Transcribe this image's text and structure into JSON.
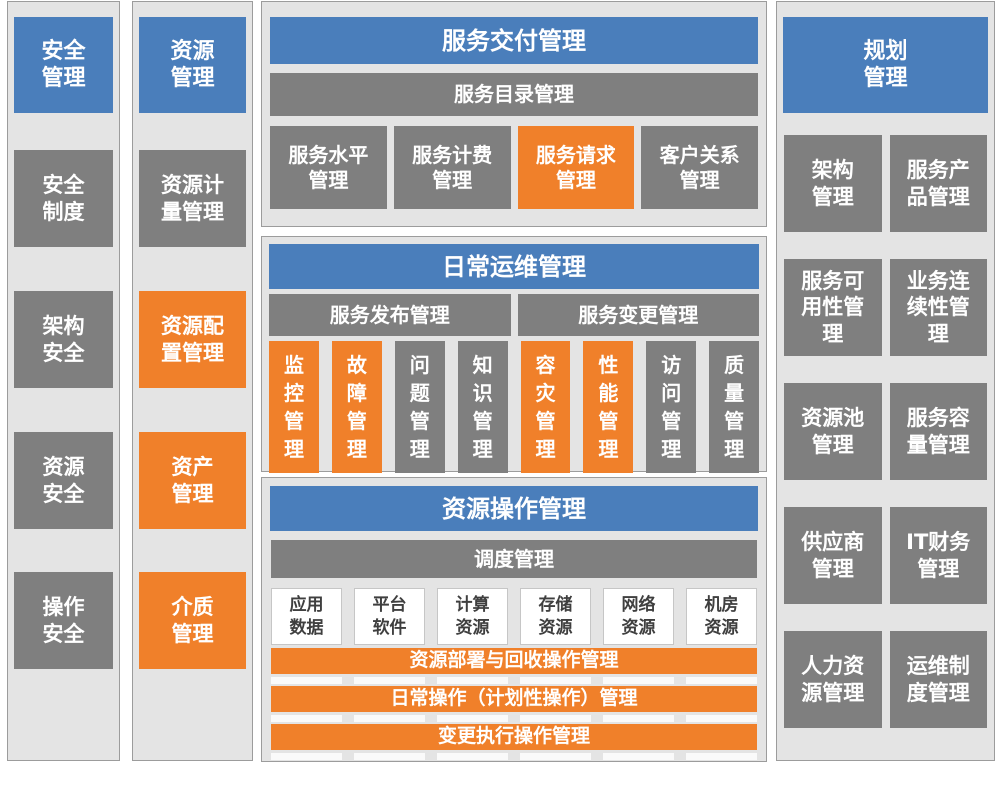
{
  "colors": {
    "blue": "#4a7ebb",
    "gray": "#7f7f7f",
    "orange": "#f0802a",
    "frame_bg": "#e4e4e4",
    "frame_border": "#9c9c9c",
    "dark_text": "#3f3f3f"
  },
  "security": {
    "title": "安全\n管理",
    "items": [
      {
        "label": "安全\n制度",
        "variant": "gray"
      },
      {
        "label": "架构\n安全",
        "variant": "gray"
      },
      {
        "label": "资源\n安全",
        "variant": "gray"
      },
      {
        "label": "操作\n安全",
        "variant": "gray"
      }
    ]
  },
  "resource": {
    "title": "资源\n管理",
    "items": [
      {
        "label": "资源计\n量管理",
        "variant": "gray"
      },
      {
        "label": "资源配\n置管理",
        "variant": "orange"
      },
      {
        "label": "资产\n管理",
        "variant": "orange"
      },
      {
        "label": "介质\n管理",
        "variant": "orange"
      }
    ]
  },
  "service_delivery": {
    "title": "服务交付管理",
    "catalog_bar": "服务目录管理",
    "boxes": [
      {
        "label": "服务水平\n管理",
        "variant": "gray"
      },
      {
        "label": "服务计费\n管理",
        "variant": "gray"
      },
      {
        "label": "服务请求\n管理",
        "variant": "orange"
      },
      {
        "label": "客户关系\n管理",
        "variant": "gray"
      }
    ]
  },
  "daily_ops": {
    "title": "日常运维管理",
    "bars": [
      "服务发布管理",
      "服务变更管理"
    ],
    "boxes": [
      {
        "label": "监\n控\n管\n理",
        "variant": "orange"
      },
      {
        "label": "故\n障\n管\n理",
        "variant": "orange"
      },
      {
        "label": "问\n题\n管\n理",
        "variant": "gray"
      },
      {
        "label": "知\n识\n管\n理",
        "variant": "gray"
      },
      {
        "label": "容\n灾\n管\n理",
        "variant": "orange"
      },
      {
        "label": "性\n能\n管\n理",
        "variant": "orange"
      },
      {
        "label": "访\n问\n管\n理",
        "variant": "gray"
      },
      {
        "label": "质\n量\n管\n理",
        "variant": "gray"
      }
    ]
  },
  "resource_ops": {
    "title": "资源操作管理",
    "schedule_bar": "调度管理",
    "resources": [
      "应用\n数据",
      "平台\n软件",
      "计算\n资源",
      "存储\n资源",
      "网络\n资源",
      "机房\n资源"
    ],
    "operation_bars": [
      "资源部署与回收操作管理",
      "日常操作（计划性操作）管理",
      "变更执行操作管理"
    ]
  },
  "planning": {
    "title": "规划\n管理",
    "items": [
      "架构\n管理",
      "服务产\n品管理",
      "服务可\n用性管\n理",
      "业务连\n续性管\n理",
      "资源池\n管理",
      "服务容\n量管理",
      "供应商\n管理",
      "IT财务\n管理",
      "人力资\n源管理",
      "运维制\n度管理"
    ]
  }
}
